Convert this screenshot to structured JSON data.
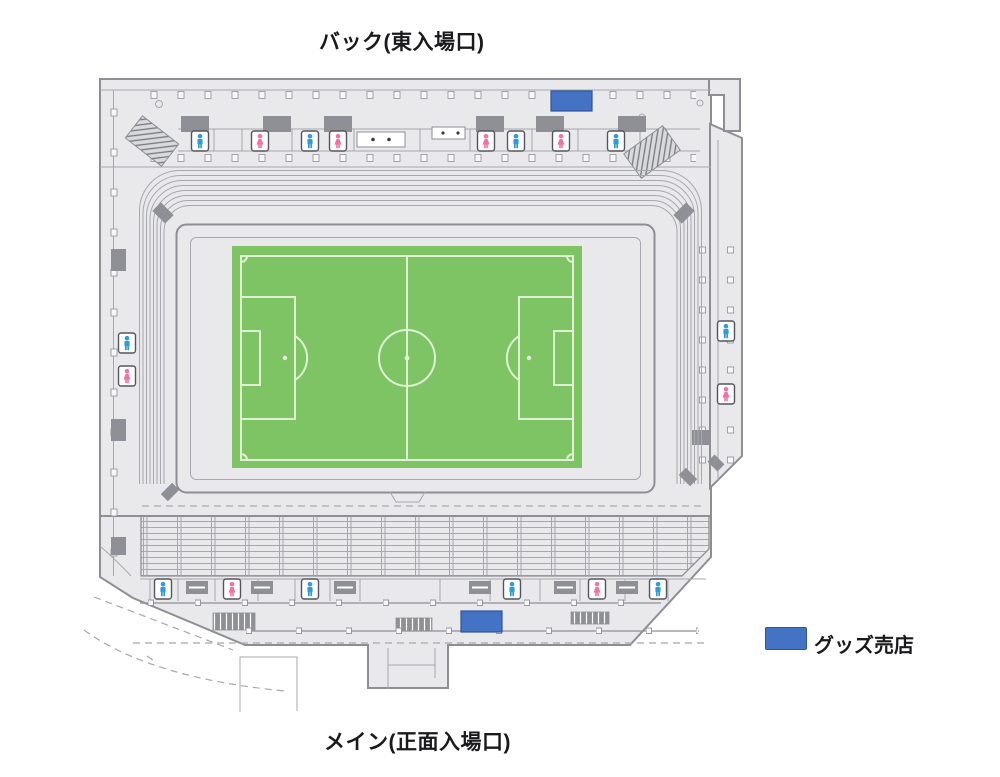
{
  "page": {
    "background": "#ffffff"
  },
  "labels": {
    "back_entrance": "バック(東入場口)",
    "main_entrance": "メイン(正面入場口)"
  },
  "legend": {
    "items": [
      {
        "label": "グッズ売店",
        "swatch_color": "#4472c4"
      }
    ]
  },
  "colors": {
    "stadium_fill": "#e9e9eb",
    "wall": "#8e8f95",
    "line": "#a7a8ad",
    "block": "#8f9096",
    "pitch_green": "#7ec464",
    "pitch_line": "#dff2d4",
    "male": "#2f9cd8",
    "female": "#f173a4",
    "shop_fill": "#4472c4",
    "shop_border": "#2f5597"
  },
  "facilities": {
    "restrooms": [
      {
        "type": "male",
        "x": 200,
        "y": 141
      },
      {
        "type": "female",
        "x": 260,
        "y": 141
      },
      {
        "type": "male",
        "x": 310,
        "y": 141
      },
      {
        "type": "female",
        "x": 338,
        "y": 141
      },
      {
        "type": "female",
        "x": 486,
        "y": 141
      },
      {
        "type": "male",
        "x": 516,
        "y": 141
      },
      {
        "type": "female",
        "x": 561,
        "y": 141
      },
      {
        "type": "male",
        "x": 616,
        "y": 141
      },
      {
        "type": "male",
        "x": 127,
        "y": 343
      },
      {
        "type": "female",
        "x": 127,
        "y": 376
      },
      {
        "type": "male",
        "x": 726,
        "y": 331
      },
      {
        "type": "female",
        "x": 726,
        "y": 394
      },
      {
        "type": "male",
        "x": 163,
        "y": 589
      },
      {
        "type": "female",
        "x": 232,
        "y": 589
      },
      {
        "type": "male",
        "x": 310,
        "y": 589
      },
      {
        "type": "male",
        "x": 512,
        "y": 589
      },
      {
        "type": "female",
        "x": 597,
        "y": 589
      },
      {
        "type": "male",
        "x": 658,
        "y": 589
      }
    ],
    "goods_shops": [
      {
        "x": 551,
        "y": 91,
        "width": 41,
        "height": 20
      },
      {
        "x": 461,
        "y": 611,
        "width": 41,
        "height": 21
      }
    ]
  }
}
